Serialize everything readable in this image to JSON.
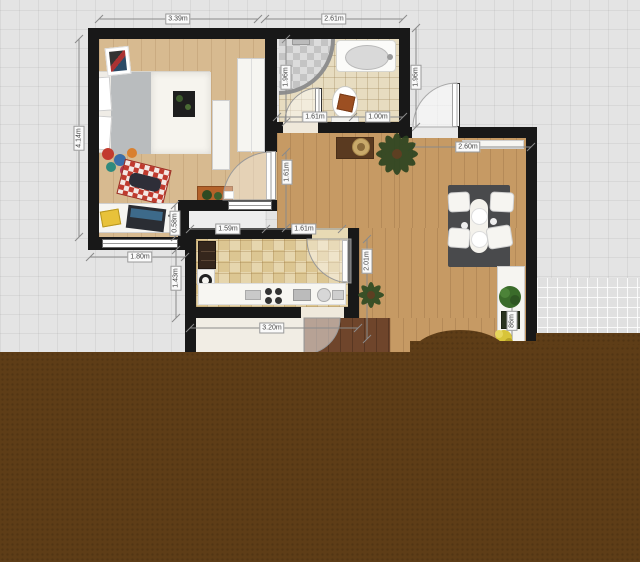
{
  "dimensions": {
    "bedroom_top": "3.39m",
    "bathroom_top": "2.61m",
    "bedroom_left": "4.14m",
    "bathroom_left": "1.96m",
    "entrance_right": "1.96m",
    "bathroom_door": "1.61m",
    "bathroom_wall": "1.00m",
    "living_top": "2.60m",
    "hallway": "1.61m",
    "kitchen_seg_a": "1.59m",
    "kitchen_seg_b": "1.61m",
    "desk_step": "0.58m",
    "bedroom_window": "1.80m",
    "kitchen_left_gap": "1.43m",
    "kitchen_right_height": "2.01m",
    "lower_room": "3.20m",
    "shelf_partial": "86m"
  },
  "colors": {
    "wall": "#181818",
    "grid_background": "#e4e4e4",
    "bedroom_floor": "#d7ba90",
    "living_floor": "#c69a64",
    "bathroom_tile": "#e7dcc0",
    "kitchen_tile": "#e3d2a8",
    "overlay_brown": "#5e3d17",
    "dining_table": "#494a4c",
    "accent_chair": "#c03a2e"
  }
}
